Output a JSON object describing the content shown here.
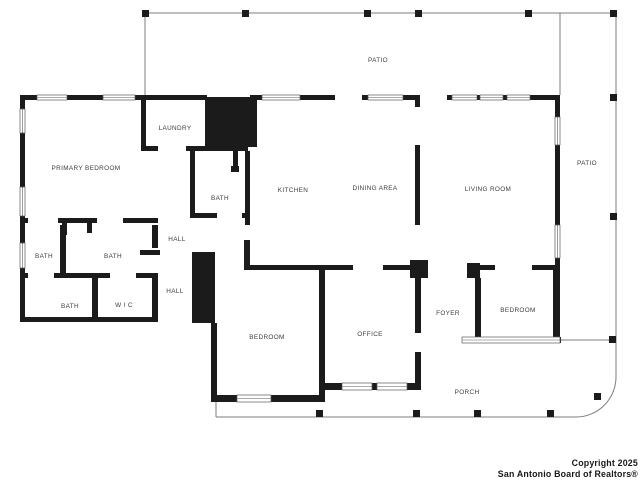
{
  "rooms": {
    "patio_top": "PATIO",
    "patio_right": "PATIO",
    "primary_bedroom": "PRIMARY BEDROOM",
    "laundry": "LAUNDRY",
    "bath_primary": "BATH",
    "kitchen": "KITCHEN",
    "dining_area": "DINING AREA",
    "living_room": "LIVING ROOM",
    "hall_upper": "HALL",
    "hall_lower": "HALL",
    "bath_left": "BATH",
    "bath_middle": "BATH",
    "bath_lower": "BATH",
    "wic": "W I C",
    "bedroom_center": "BEDROOM",
    "office": "OFFICE",
    "foyer": "FOYER",
    "bedroom_right": "BEDROOM",
    "porch": "PORCH"
  },
  "footer": {
    "line1": "Copyright 2025",
    "line2": "San Antonio Board of Realtors®"
  },
  "colors": {
    "walls": "#1b1b1b",
    "outline": "#7d7d7d",
    "room_text": "#3d3d3d",
    "copyright_text": "#181818",
    "background": "#ffffff"
  }
}
